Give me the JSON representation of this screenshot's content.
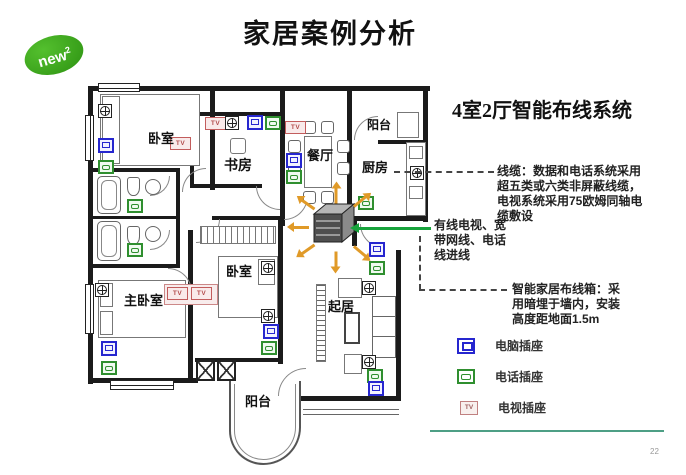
{
  "slide": {
    "title": "家居案例分析",
    "page_number": "22"
  },
  "logo": {
    "text": "new",
    "sup": "2"
  },
  "right_panel": {
    "subtitle": "4室2厅智能布线系统",
    "cable_note": "线缆：数据和电话系统采用\n超五类或六类非屏蔽线缆，\n电视系统采用75欧姆同轴电\n缆敷设",
    "inlet_note": "有线电视、宽\n带网线、电话\n线进线",
    "box_note": "智能家居布线箱：采\n用暗埋于墙内，安装\n高度距地面1.5m",
    "legend": [
      {
        "icon": "computer-socket-icon",
        "label": "电脑插座"
      },
      {
        "icon": "phone-socket-icon",
        "label": "电话插座"
      },
      {
        "icon": "tv-socket-icon",
        "label": "电视插座"
      }
    ]
  },
  "floorplan": {
    "tv_label": "TV",
    "rooms": [
      {
        "id": "bedroom-1",
        "label": "卧室"
      },
      {
        "id": "study",
        "label": "书房"
      },
      {
        "id": "dining",
        "label": "餐厅"
      },
      {
        "id": "balcony-top",
        "label": "阳台"
      },
      {
        "id": "kitchen",
        "label": "厨房"
      },
      {
        "id": "master-bedroom",
        "label": "主卧室"
      },
      {
        "id": "bedroom-2",
        "label": "卧室"
      },
      {
        "id": "living",
        "label": "起居"
      },
      {
        "id": "balcony-bottom",
        "label": "阳台"
      }
    ]
  },
  "colors": {
    "accent_green": "#18a33c",
    "arrow_orange": "#e09a28",
    "divider_teal": "#4d9f85",
    "socket_blue": "#2626cf",
    "socket_green": "#2f8f2f",
    "socket_red": "#c25c5c",
    "logo_green": "#2d9212"
  }
}
